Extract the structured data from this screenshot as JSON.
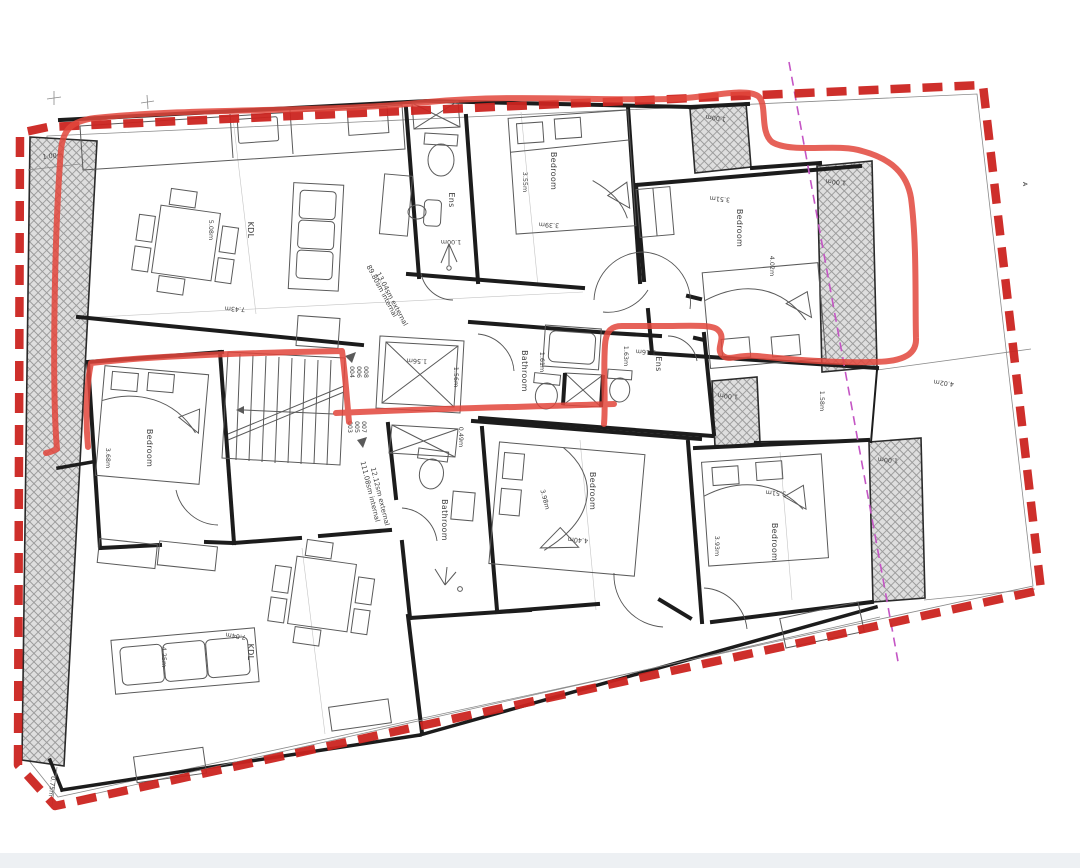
{
  "page": {
    "background": "#ffffff",
    "footer_bar_color": "#edf0f3"
  },
  "colors": {
    "boundary_red": "#cb2420",
    "marker_red": "#e2463c",
    "section_magenta": "#c455c4",
    "wall_line": "#1c1c1c",
    "hatch_fill": "#dedede",
    "hatch_line": "#9a9a9a",
    "dim_text": "#3f3f3f"
  },
  "labels": {
    "kdl": "KDL",
    "bedroom": "Bedroom",
    "ensuite": "Ens",
    "bathroom": "Bathroom",
    "section_marker": "A"
  },
  "areas": {
    "upper_internal": "89.80sm internal",
    "upper_external": "13.04sm external",
    "lower_internal": "111.08sm internal",
    "lower_external": "12.12sm external"
  },
  "unit_numbers": {
    "up": [
      "004",
      "006",
      "008"
    ],
    "down": [
      "003",
      "005",
      "007"
    ]
  },
  "dimensions": {
    "d100": "1.00m",
    "d075": "0.75m",
    "d743": "7.43m",
    "d508": "5.08m",
    "d355": "3.55m",
    "d339": "3.39m",
    "d351": "3.51m",
    "d402": "4.02m",
    "d368": "3.68m",
    "d156": "1.56m",
    "d049": "0.49m",
    "d161": "1.61m",
    "d163": "1.63m",
    "d116": "1.16m",
    "d158": "1.58m",
    "d704": "7.04m",
    "d425": "4.25m",
    "d398": "3.98m",
    "d440": "4.40m",
    "d393": "3.93m"
  }
}
